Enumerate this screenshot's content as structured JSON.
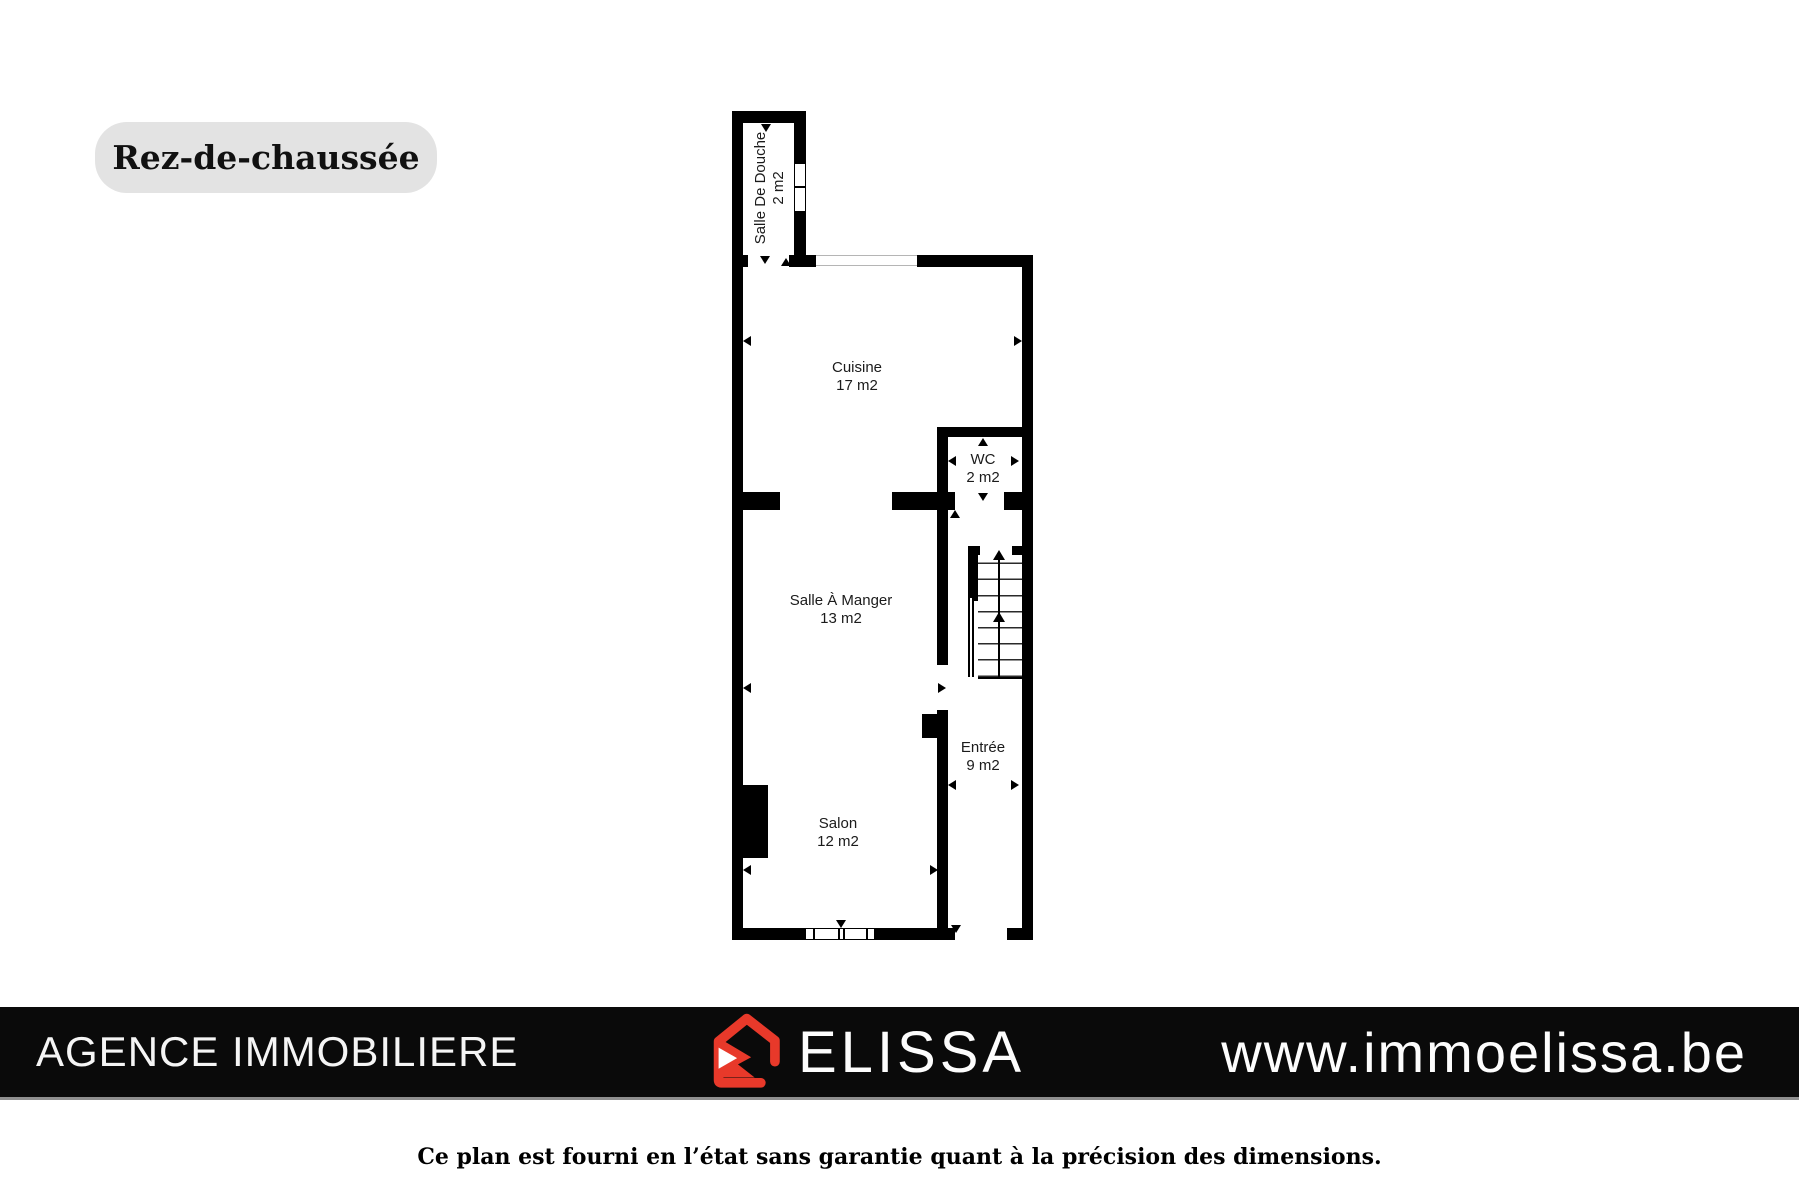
{
  "floor_label": "Rez-de-chaussée",
  "plan": {
    "wall_color": "#000000",
    "rooms": [
      {
        "name": "Salle De Douche",
        "area": "2 m2"
      },
      {
        "name": "Cuisine",
        "area": "17 m2"
      },
      {
        "name": "WC",
        "area": "2 m2"
      },
      {
        "name": "Salle À Manger",
        "area": "13 m2"
      },
      {
        "name": "Entrée",
        "area": "9 m2"
      },
      {
        "name": "Salon",
        "area": "12 m2"
      }
    ]
  },
  "footer": {
    "agency_name": "AGENCE IMMOBILIERE",
    "brand_name": "ELISSA",
    "website": "www.immoelissa.be",
    "logo_icon": "red-house-icon",
    "bar_color": "#0a0a0a",
    "accent_color": "#e8392a"
  },
  "disclaimer": "Ce plan est fourni en l’état sans garantie quant à la précision des dimensions."
}
